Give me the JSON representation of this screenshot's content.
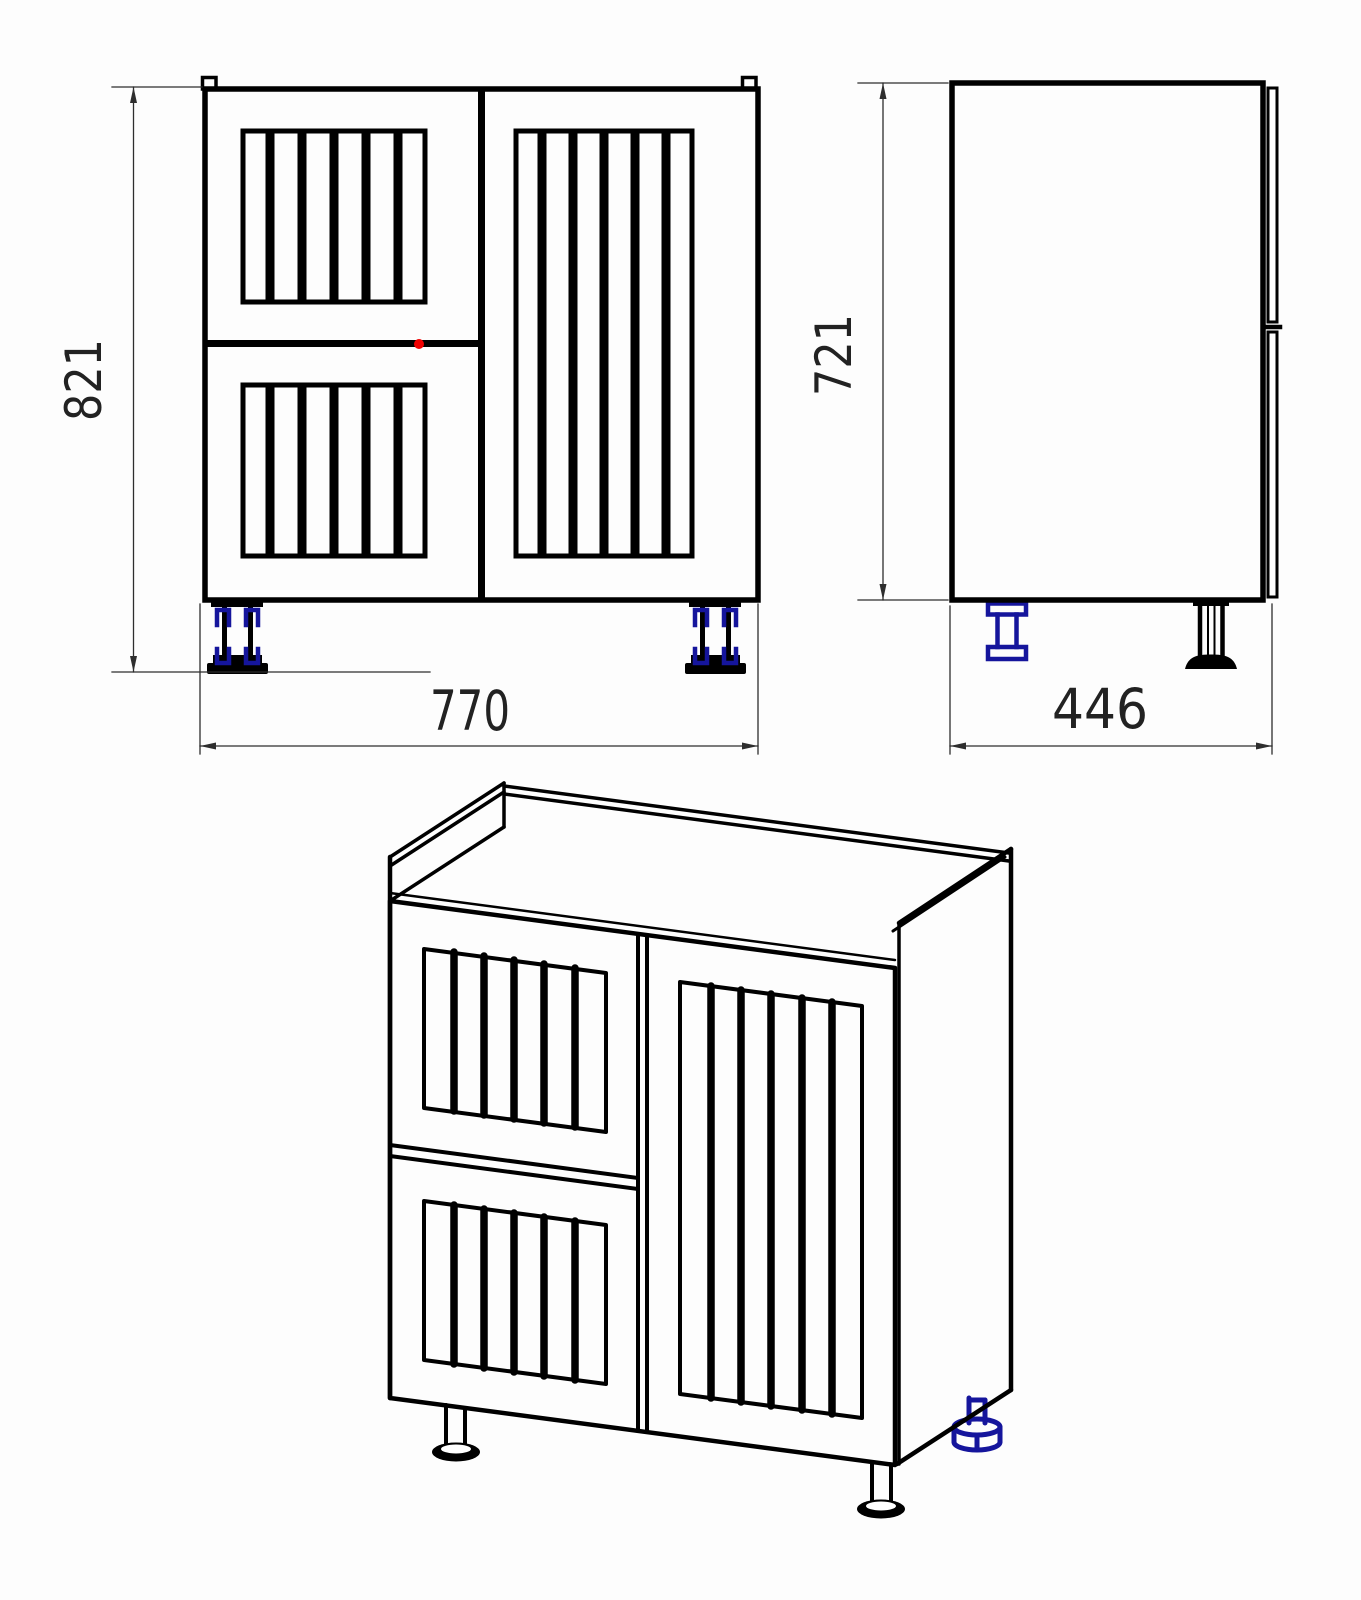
{
  "drawing": {
    "dimensions": {
      "front_height": "821",
      "front_width": "770",
      "side_height": "721",
      "side_depth": "446"
    },
    "colors": {
      "line": "#000000",
      "accent_blue": "#15159c",
      "marker_red": "#f00000",
      "dimension_line": "#2e2e2e",
      "background": "#fdfdfd"
    }
  }
}
